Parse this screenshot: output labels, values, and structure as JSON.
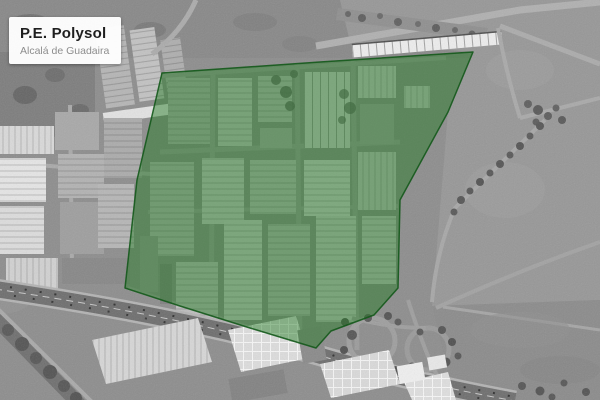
{
  "label_card": {
    "title": "P.E. Polysol",
    "subtitle": "Alcalá de Guadaira"
  },
  "map": {
    "highlight": {
      "name": "P.E. Polysol",
      "fill": "#1e7a1e",
      "fill_opacity": "0.45",
      "stroke": "#14591b",
      "stroke_opacity": "0.9",
      "stroke_width": "1.5",
      "polygon_points": "162,73 320,62 473,52 448,112 400,200 398,288 374,315 331,331 316,348 250,328 180,306 125,288 137,180"
    }
  }
}
